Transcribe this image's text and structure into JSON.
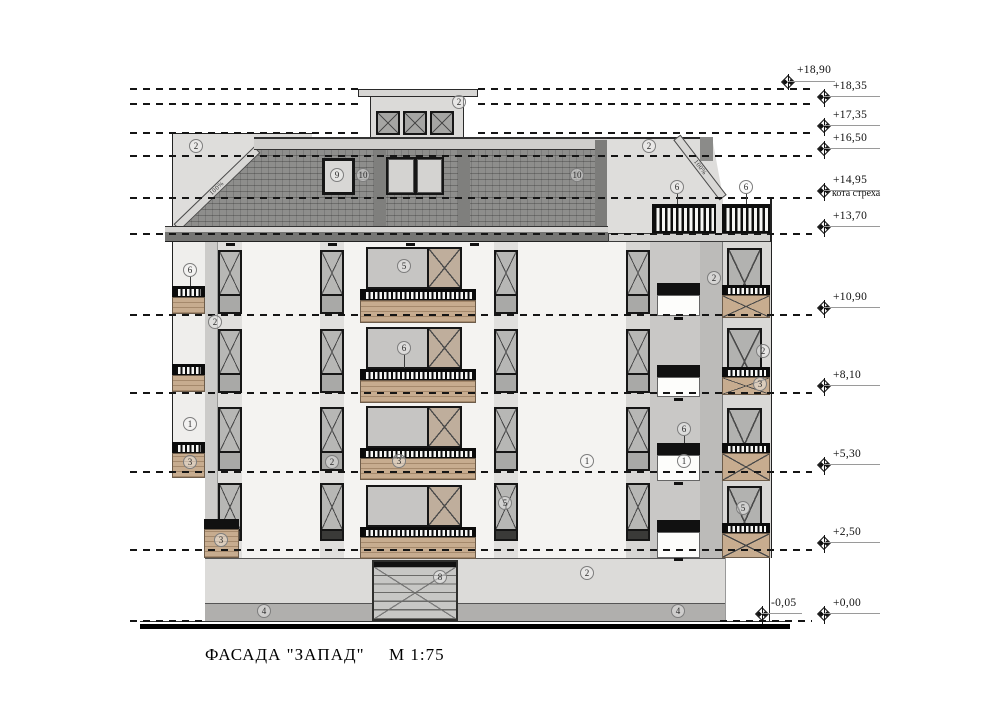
{
  "drawing": {
    "title": "ФАСАДА \"ЗАПАД\"",
    "scale": "М 1:75"
  },
  "elevations": [
    {
      "value": "+18,90"
    },
    {
      "value": "+18,35"
    },
    {
      "value": "+17,35"
    },
    {
      "value": "+16,50"
    },
    {
      "value": "+14,95",
      "note": "кота стреха"
    },
    {
      "value": "+13,70"
    },
    {
      "value": "+10,90"
    },
    {
      "value": "+8,10"
    },
    {
      "value": "+5,30"
    },
    {
      "value": "+2,50"
    },
    {
      "value": "+0,00"
    },
    {
      "value": "-0,05"
    }
  ],
  "slope_labels": {
    "left": "100%",
    "right": "100%"
  },
  "callouts": [
    {
      "text": "2"
    },
    {
      "text": "2"
    },
    {
      "text": "2"
    },
    {
      "text": "9"
    },
    {
      "text": "10"
    },
    {
      "text": "10"
    },
    {
      "text": "6"
    },
    {
      "text": "6"
    },
    {
      "text": "6"
    },
    {
      "text": "2"
    },
    {
      "text": "2"
    },
    {
      "text": "1"
    },
    {
      "text": "3"
    },
    {
      "text": "3"
    },
    {
      "text": "5"
    },
    {
      "text": "6"
    },
    {
      "text": "3"
    },
    {
      "text": "2"
    },
    {
      "text": "5"
    },
    {
      "text": "1"
    },
    {
      "text": "6"
    },
    {
      "text": "1"
    },
    {
      "text": "2"
    },
    {
      "text": "3"
    },
    {
      "text": "5"
    },
    {
      "text": "8"
    },
    {
      "text": "2"
    },
    {
      "text": "4"
    },
    {
      "text": "4"
    }
  ],
  "colors": {
    "roof_tile": "#8e8e8c",
    "eave_band": "#767674",
    "wall_white": "#f4f3f1",
    "wall_gray": "#c9c8c6",
    "wood_panel": "#c7ac8f",
    "window_frame": "#161616",
    "ground": "#dcdbd9",
    "plinth": "#b0afad"
  }
}
